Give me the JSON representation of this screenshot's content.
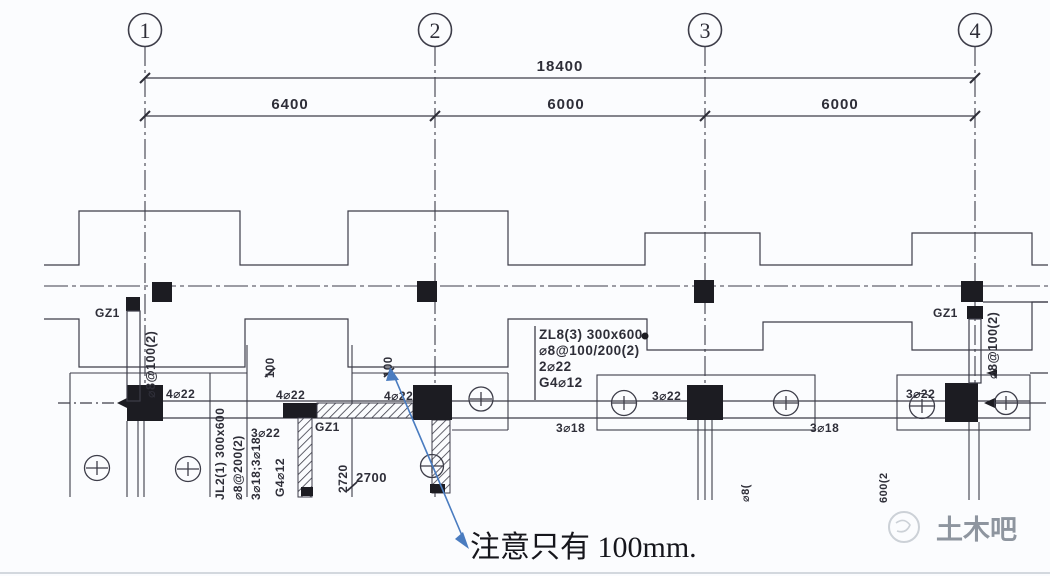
{
  "colors": {
    "line": "#3d3d49",
    "text": "#2e2e38",
    "note_text": "#16161c",
    "leader_blue": "#4a7cc0",
    "watermark_gray": "#8e959f",
    "edge_gray": "#c6cbd3"
  },
  "grid_bubbles": {
    "b1": "1",
    "b2": "2",
    "b3": "3",
    "b4": "4"
  },
  "dimensions": {
    "overall": "18400",
    "span_12": "6400",
    "span_23": "6000",
    "span_34": "6000",
    "beam_width_left": "100",
    "beam_width_right": "100",
    "opening_width": "2700",
    "opening_height": "2720"
  },
  "column_labels": {
    "gz1_grid1": "GZ1",
    "gz1_mid": "GZ1",
    "gz1_grid4": "GZ1"
  },
  "beam_zl8": {
    "name_size": "ZL8(3) 300x600",
    "stirrups": "⌀8@100/200(2)",
    "top_bars": "2⌀22",
    "side_bars": "G4⌀12"
  },
  "beam_jl2": {
    "name_size": "JL2(1) 300x600",
    "stirrups": "⌀8@200(2)",
    "bottom_bars": "3⌀18;3⌀18",
    "side_bars": "G4⌀12"
  },
  "rebar_labels": {
    "g1_top": "4⌀22",
    "mid_top": "4⌀22",
    "g2_top": "4⌀22",
    "mid_bottom": "3⌀22",
    "g3_top": "3⌀22",
    "g4_top": "3⌀22",
    "span2_bottom": "3⌀18",
    "span3_bottom": "3⌀18",
    "stirrup_grid1": "⌀8@100(2)",
    "stirrup_grid4": "⌀8@100(2)",
    "fragment_left": "⌀8(",
    "fragment_right": "600(2"
  },
  "note": {
    "text": "注意只有 100mm."
  },
  "watermark": {
    "text": "土木吧"
  }
}
